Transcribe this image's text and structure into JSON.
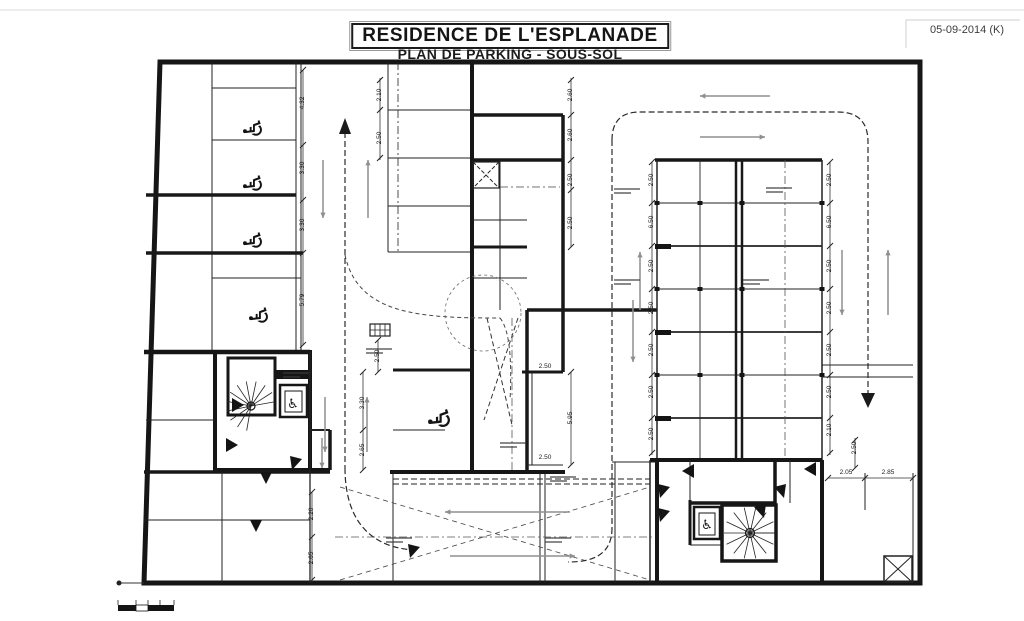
{
  "page": {
    "title": "RESIDENCE DE L'ESPLANADE",
    "subtitle": "PLAN DE PARKING - SOUS-SOL",
    "revision_date": "05-09-2014 (K)"
  },
  "icons": {
    "wheelchair": "♿"
  },
  "dimension_labels": [
    {
      "value": "4.32",
      "x": 303,
      "y": 103,
      "rot": 1
    },
    {
      "value": "3.30",
      "x": 303,
      "y": 168,
      "rot": 1
    },
    {
      "value": "3.30",
      "x": 303,
      "y": 225,
      "rot": 1
    },
    {
      "value": "5.79",
      "x": 303,
      "y": 300,
      "rot": 1
    },
    {
      "value": "2.10",
      "x": 380,
      "y": 95,
      "rot": 1
    },
    {
      "value": "2.50",
      "x": 380,
      "y": 138,
      "rot": 1
    },
    {
      "value": "2.50",
      "x": 378,
      "y": 356,
      "rot": 1
    },
    {
      "value": "3.30",
      "x": 363,
      "y": 403,
      "rot": 1
    },
    {
      "value": "2.65",
      "x": 363,
      "y": 450,
      "rot": 1
    },
    {
      "value": "2.60",
      "x": 571,
      "y": 95,
      "rot": 1
    },
    {
      "value": "2.60",
      "x": 571,
      "y": 135,
      "rot": 1
    },
    {
      "value": "2.50",
      "x": 571,
      "y": 180,
      "rot": 1
    },
    {
      "value": "2.50",
      "x": 571,
      "y": 223,
      "rot": 1
    },
    {
      "value": "5.95",
      "x": 571,
      "y": 418,
      "rot": 1
    },
    {
      "value": "2.50",
      "x": 545,
      "y": 367,
      "rot": 0
    },
    {
      "value": "2.50",
      "x": 545,
      "y": 458,
      "rot": 0
    },
    {
      "value": "2.50",
      "x": 652,
      "y": 180,
      "rot": 1
    },
    {
      "value": "6.50",
      "x": 652,
      "y": 222,
      "rot": 1
    },
    {
      "value": "2.50",
      "x": 652,
      "y": 266,
      "rot": 1
    },
    {
      "value": "2.50",
      "x": 652,
      "y": 308,
      "rot": 1
    },
    {
      "value": "2.50",
      "x": 652,
      "y": 350,
      "rot": 1
    },
    {
      "value": "2.50",
      "x": 652,
      "y": 392,
      "rot": 1
    },
    {
      "value": "2.50",
      "x": 652,
      "y": 434,
      "rot": 1
    },
    {
      "value": "2.50",
      "x": 830,
      "y": 180,
      "rot": 1
    },
    {
      "value": "6.50",
      "x": 830,
      "y": 222,
      "rot": 1
    },
    {
      "value": "2.50",
      "x": 830,
      "y": 266,
      "rot": 1
    },
    {
      "value": "2.50",
      "x": 830,
      "y": 308,
      "rot": 1
    },
    {
      "value": "2.50",
      "x": 830,
      "y": 350,
      "rot": 1
    },
    {
      "value": "2.50",
      "x": 830,
      "y": 392,
      "rot": 1
    },
    {
      "value": "2.10",
      "x": 830,
      "y": 430,
      "rot": 1
    },
    {
      "value": "2.20",
      "x": 312,
      "y": 514,
      "rot": 1
    },
    {
      "value": "2.65",
      "x": 312,
      "y": 558,
      "rot": 1
    },
    {
      "value": "2.05",
      "x": 846,
      "y": 473,
      "rot": 0
    },
    {
      "value": "2.85",
      "x": 888,
      "y": 473,
      "rot": 0
    },
    {
      "value": "2.50",
      "x": 855,
      "y": 448,
      "rot": 1
    }
  ]
}
